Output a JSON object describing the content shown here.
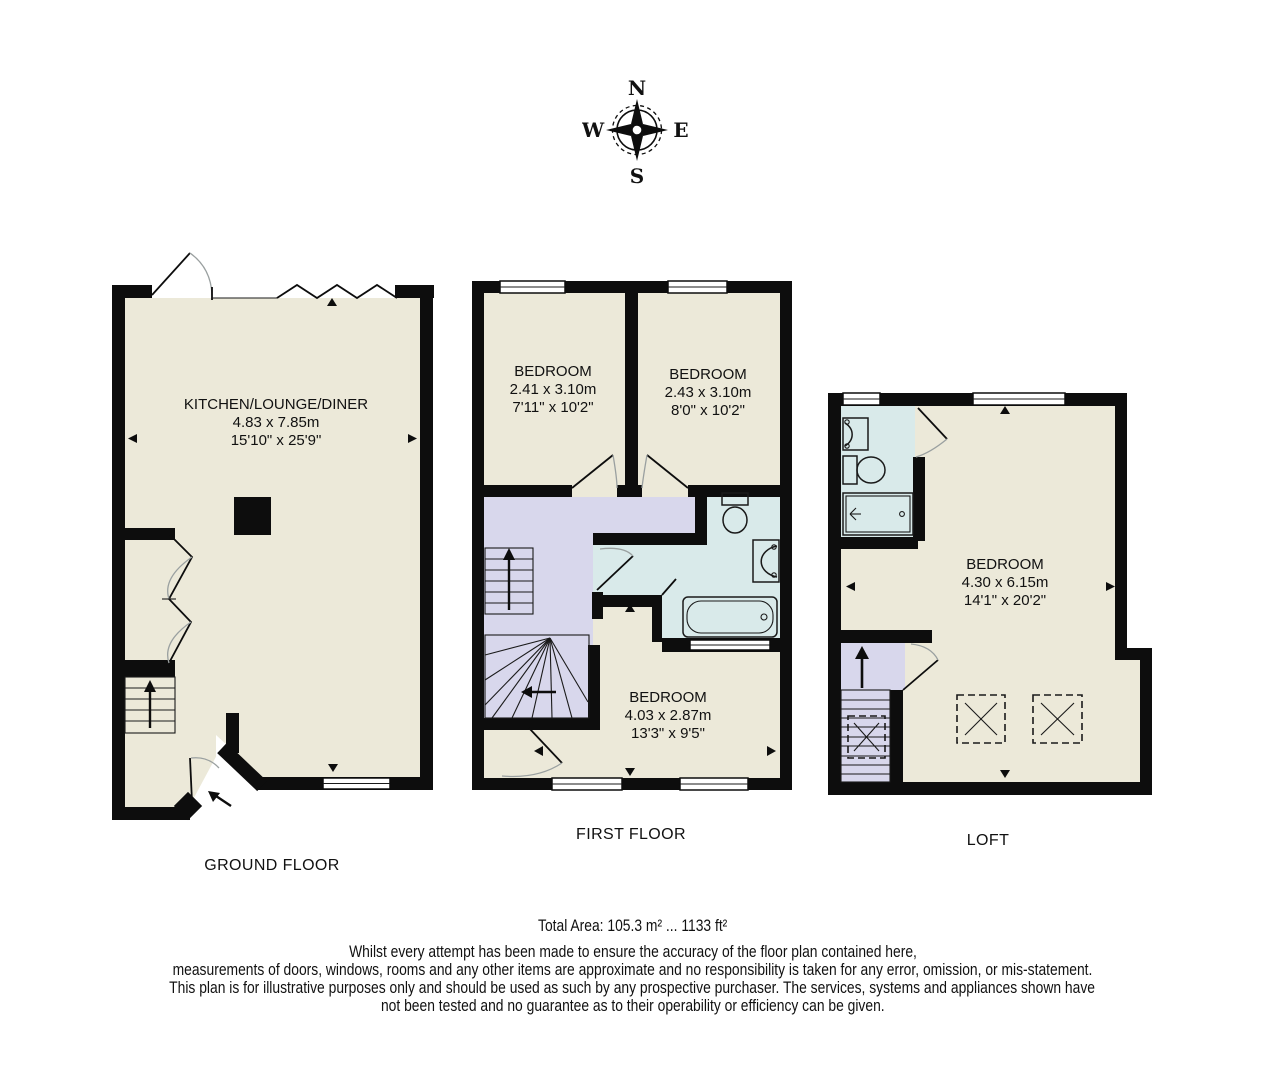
{
  "compass": {
    "north": "N",
    "east": "E",
    "south": "S",
    "west": "W"
  },
  "floors": [
    {
      "label": "GROUND FLOOR",
      "rooms": [
        {
          "name": "KITCHEN/LOUNGE/DINER",
          "size_metric": "4.83 x 7.85m",
          "size_imperial": "15'10\" x 25'9\""
        }
      ]
    },
    {
      "label": "FIRST FLOOR",
      "rooms": [
        {
          "name": "BEDROOM",
          "size_metric": "2.41 x 3.10m",
          "size_imperial": "7'11\" x 10'2\""
        },
        {
          "name": "BEDROOM",
          "size_metric": "2.43 x 3.10m",
          "size_imperial": "8'0\" x 10'2\""
        },
        {
          "name": "BEDROOM",
          "size_metric": "4.03 x 2.87m",
          "size_imperial": "13'3\" x 9'5\""
        }
      ]
    },
    {
      "label": "LOFT",
      "rooms": [
        {
          "name": "BEDROOM",
          "size_metric": "4.30 x 6.15m",
          "size_imperial": "14'1\" x 20'2\""
        }
      ]
    }
  ],
  "footer": {
    "total_area": "Total Area: 105.3 m² ... 1133 ft²",
    "disclaimer": [
      "Whilst every attempt has been made to ensure the accuracy of the floor plan contained here,",
      "measurements of doors, windows, rooms and any other items are approximate and no responsibility is taken for any error, omission, or mis-statement.",
      "This plan is for illustrative purposes only and should be used as such by any prospective purchaser. The services, systems and appliances shown have",
      "not been tested and no guarantee as to their operability or efficiency can be given."
    ]
  },
  "colors": {
    "wall": "#0d0d0d",
    "room_fill": "#ece9d9",
    "landing_fill": "#d8d7ec",
    "bathroom_fill": "#d9eaea",
    "door_arc": "#9aa0a0"
  }
}
